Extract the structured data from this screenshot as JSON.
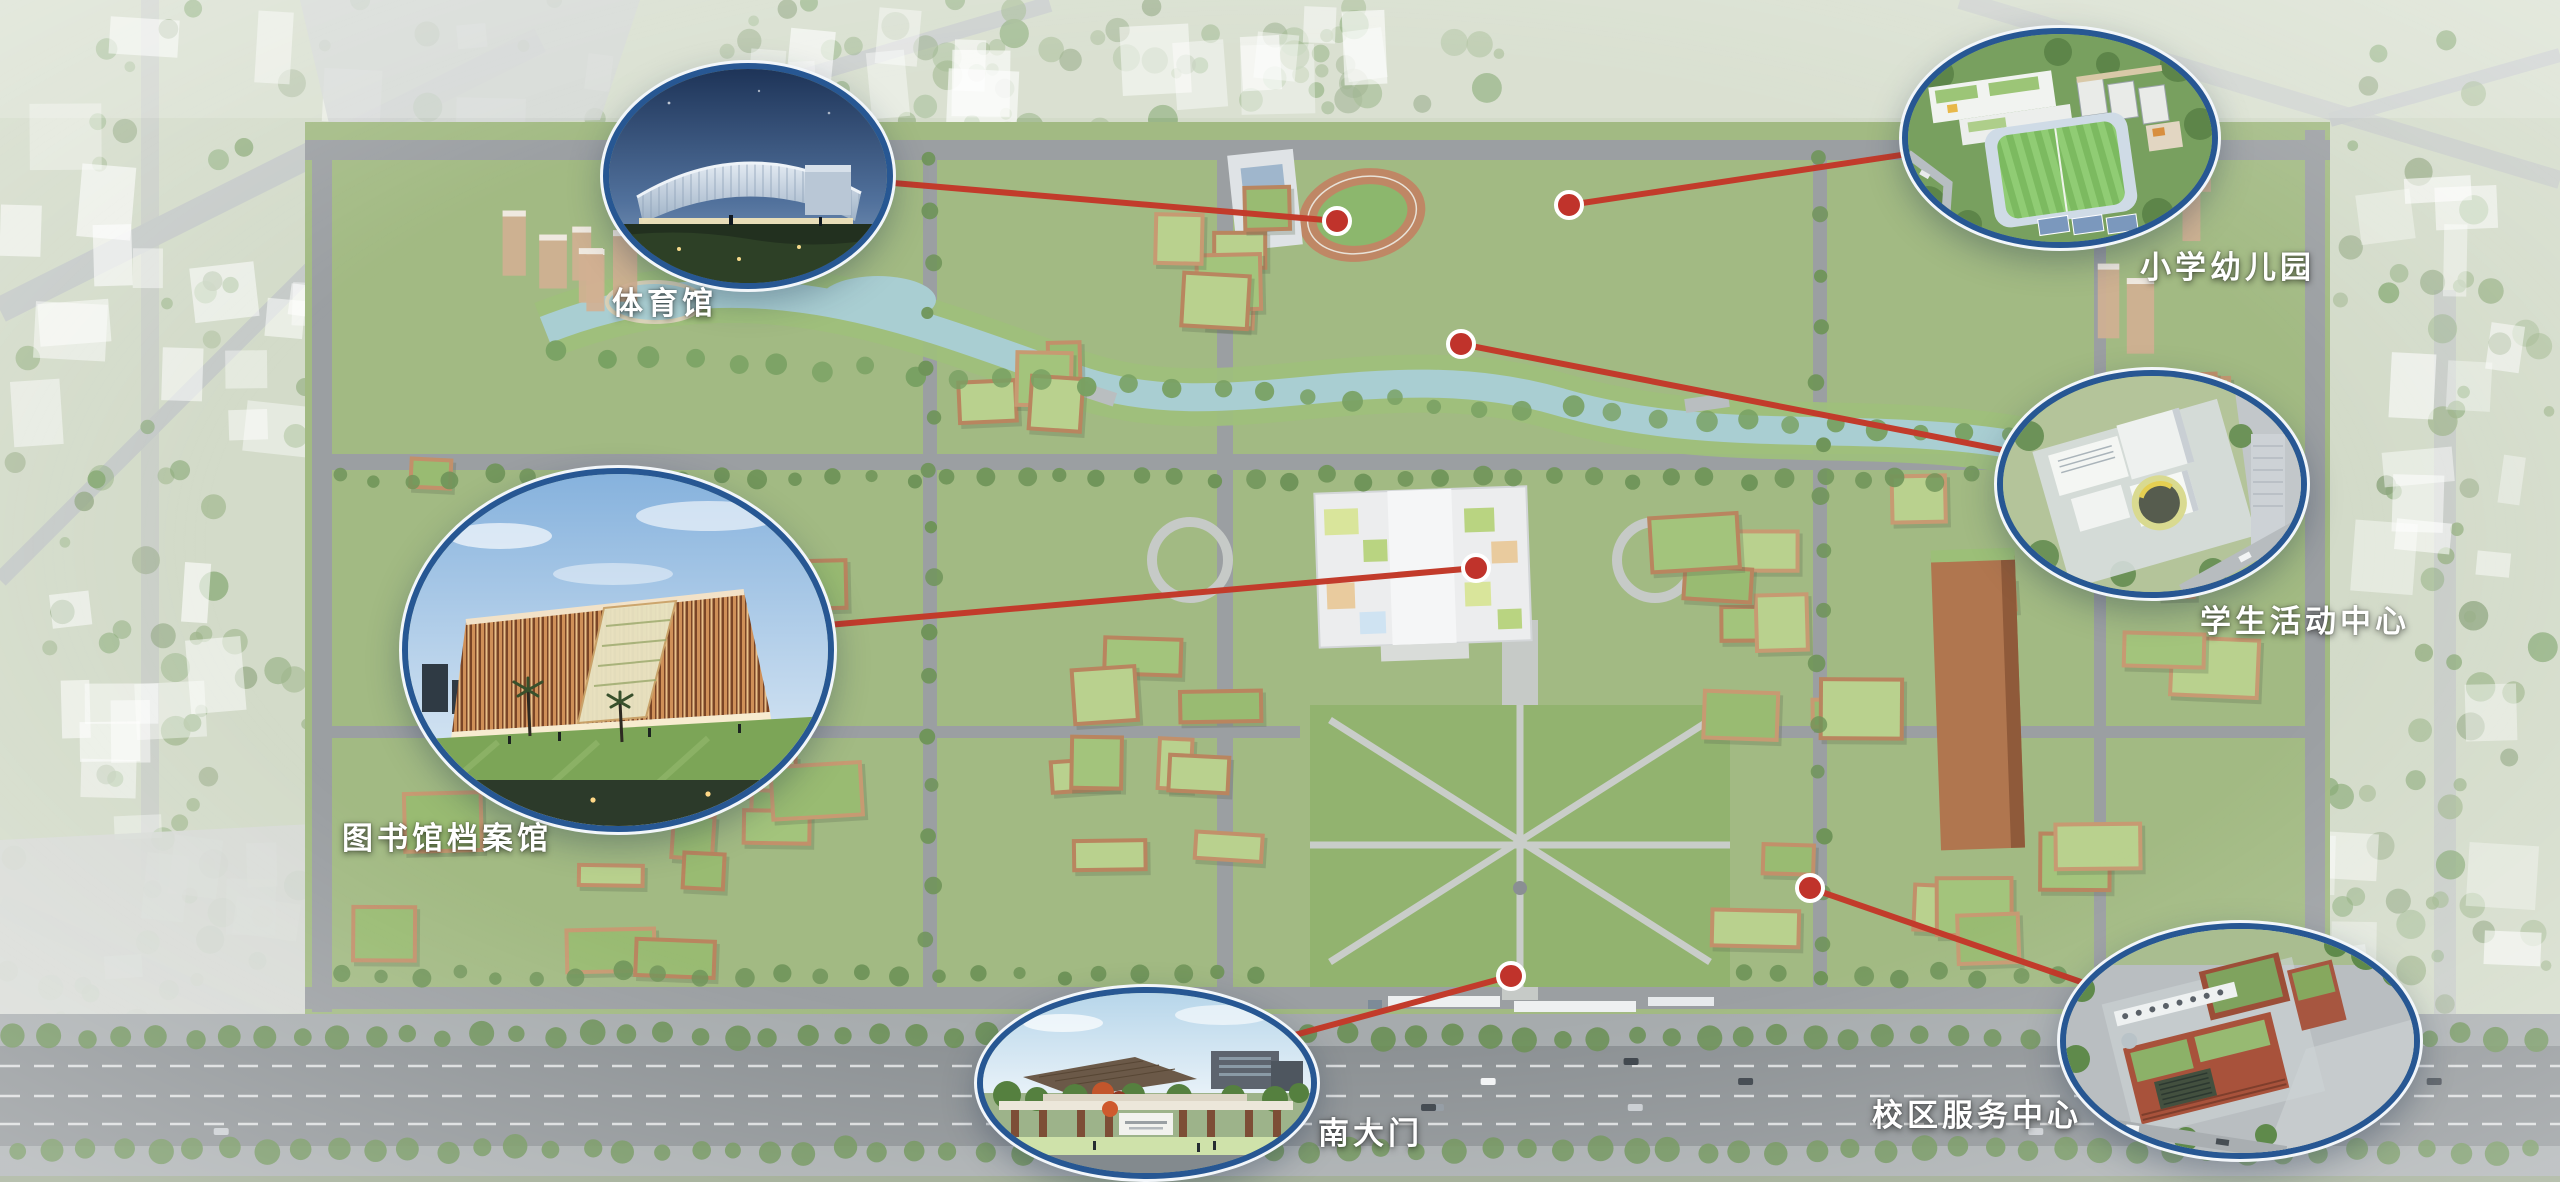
{
  "scene_type": "campus-aerial-masterplan-rendering",
  "colors": {
    "callout_border": "#275793",
    "callout_rim": "#f2f6fa",
    "connector_red": "#c23b2b",
    "marker_red": "#c0332b",
    "marker_rim": "#ffffff",
    "label_white": "#ffffff"
  },
  "callouts": [
    {
      "id": "gymnasium",
      "label": "体育馆"
    },
    {
      "id": "primary-school-kindergarten",
      "label": "小学幼儿园"
    },
    {
      "id": "student-activity-center",
      "label": "学生活动中心"
    },
    {
      "id": "library-archives",
      "label": "图书馆档案馆"
    },
    {
      "id": "south-gate",
      "label": "南大门"
    },
    {
      "id": "campus-service-center",
      "label": "校区服务中心"
    }
  ]
}
